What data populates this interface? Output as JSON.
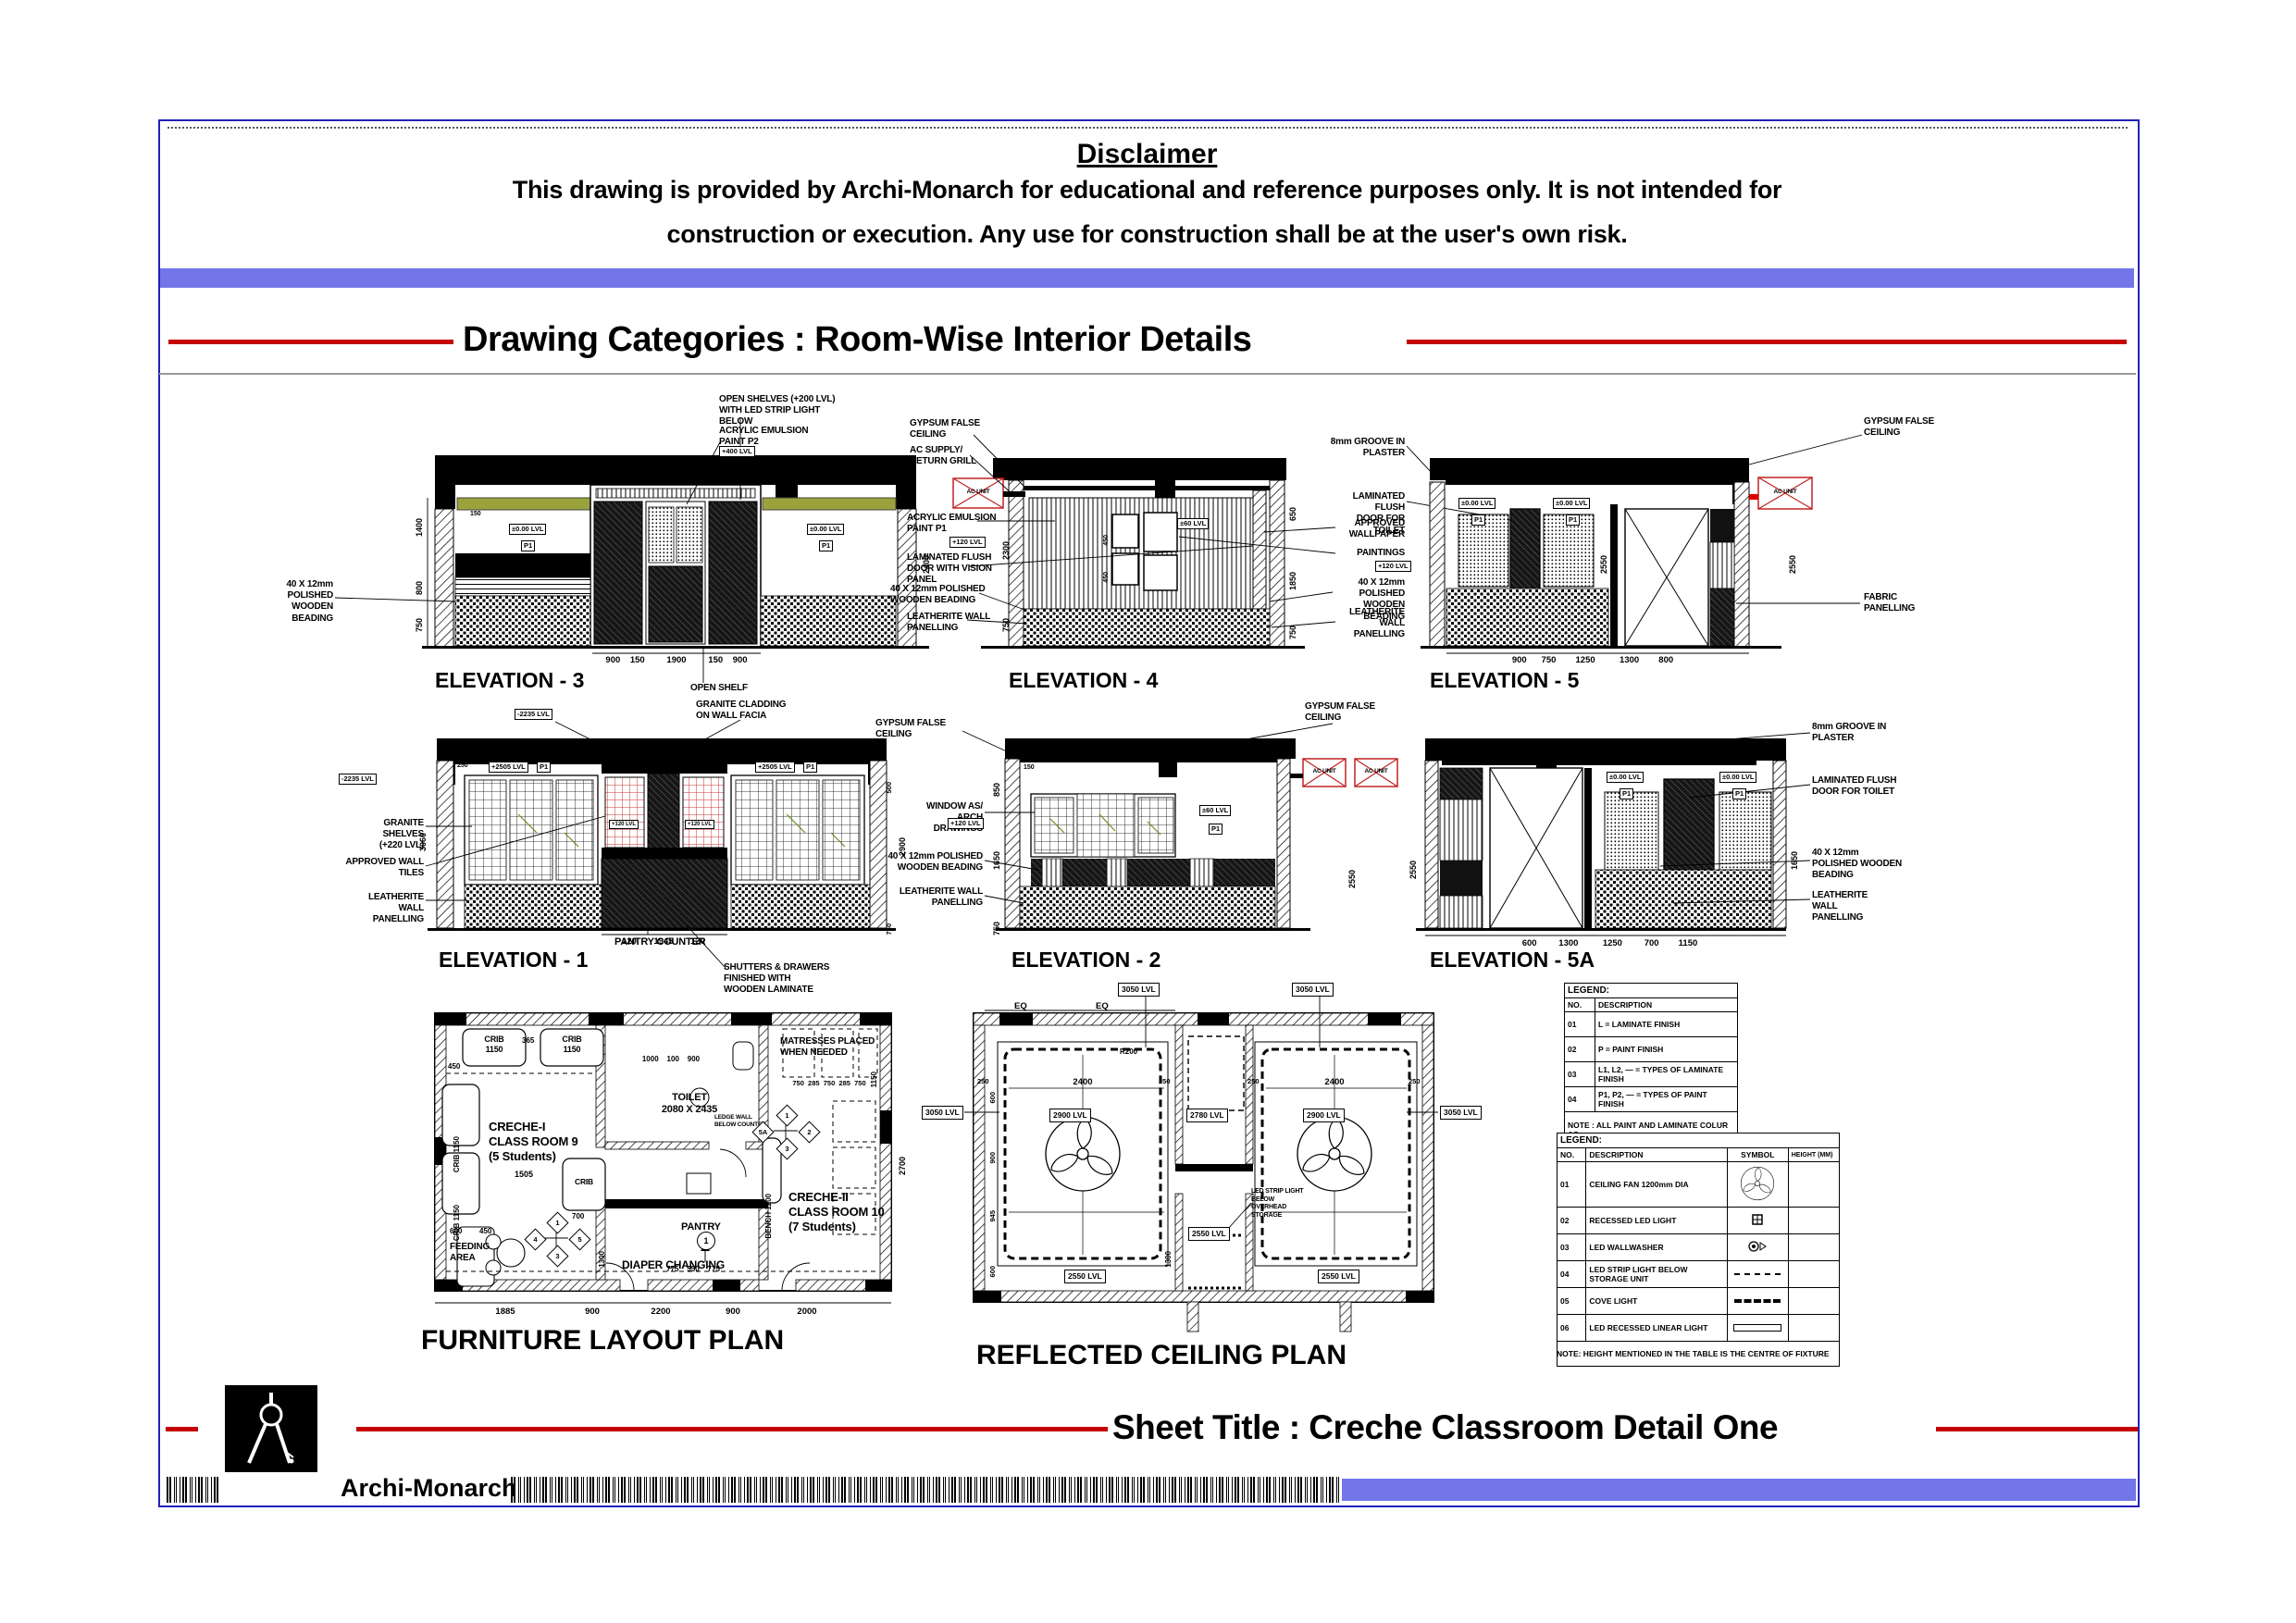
{
  "header": {
    "disclaimer_title": "Disclaimer",
    "disclaimer_line1": "This drawing is provided by Archi-Monarch for educational and reference purposes only. It is not intended for",
    "disclaimer_line2": "construction or execution. Any use for construction shall be at the user's own risk.",
    "category_title": "Drawing Categories : Room-Wise Interior Details"
  },
  "footer": {
    "sheet_title": "Sheet Title : Creche Classroom Detail One",
    "brand": "Archi-Monarch"
  },
  "e3": {
    "title": "ELEVATION - 3",
    "open_shelves": "OPEN SHELVES (+200 LVL)\nWITH LED STRIP LIGHT\nBELOW",
    "acrylic": "ACRYLIC EMULSION\nPAINT P2",
    "tag_400": "+400 LVL",
    "beading": "40 X 12mm\nPOLISHED\nWOODEN\nBEADING",
    "open_shelf": "OPEN SHELF",
    "lvl": "±0.00 LVL",
    "p1": "P1",
    "lvl_b": "±0.00 LVL",
    "p1_b": "P1",
    "dims_bottom": "900    150         1900         150    900",
    "dims_left": [
      "1400",
      "800",
      "750"
    ],
    "dim_right": "2400",
    "dim_150": "150"
  },
  "e4": {
    "title": "ELEVATION - 4",
    "gypsum": "GYPSUM FALSE\nCEILING",
    "ac_supply": "AC SUPPLY/\nRETURN GRILL",
    "acrylic": "ACRYLIC EMULSION\nPAINT P1",
    "tag_120": "+120 LVL",
    "flush_door": "LAMINATED FLUSH\nDOOR WITH VISION\nPANEL",
    "beading": "40 X 12mm POLISHED\nWOODEN BEADING",
    "leatherite": "LEATHERITE WALL\nPANELLING",
    "ac_unit": "AC UNIT",
    "tag_60": "±60 LVL",
    "dims_left": [
      "2300",
      "750"
    ],
    "dims_right": [
      "650",
      "1850",
      "750"
    ],
    "dim_450a": "450",
    "dim_450b": "450",
    "dim_150": "150"
  },
  "e45": {
    "groove": "8mm GROOVE IN\nPLASTER",
    "toilet_door": "LAMINATED FLUSH\nDOOR FOR TOILET",
    "wallpaper": "APPROVED\nWALLPAPER",
    "paintings": "PAINTINGS",
    "tag_120": "+120 LVL",
    "beading": "40 X 12mm\nPOLISHED WOODEN\nBEADING",
    "leatherite": "LEATHERITE\nWALL\nPANELLING"
  },
  "e5": {
    "title": "ELEVATION - 5",
    "gypsum": "GYPSUM FALSE\nCEILING",
    "fabric": "FABRIC\nPANELLING",
    "ac_unit": "AC UNIT",
    "lvl": "±0.00 LVL",
    "p1": "P1",
    "lvl_b": "±0.00 LVL",
    "p1_b": "P1",
    "dims_bottom": "900      750        1250          1300        800",
    "dims_right": [
      "2550",
      "2550"
    ]
  },
  "e1": {
    "title": "ELEVATION - 1",
    "granite_cladding": "GRANITE CLADDING\nON WALL FACIA",
    "granite_shelves": "GRANITE SHELVES\n(+220 LVL)",
    "wall_tiles": "APPROVED WALL\nTILES",
    "leatherite": "LEATHERITE WALL\nPANELLING",
    "pantry_counter": "PANTRY COUNTER",
    "shutters": "SHUTTERS & DRAWERS\nFINISHED WITH\nWOODEN LAMINATE",
    "tag_2235a": "-2235 LVL",
    "tag_2235b": "-2235 LVL",
    "tag_2505a": "+2505 LVL",
    "p1a": "P1",
    "tag_2505b": "+2505 LVL",
    "p1b": "P1",
    "tag_120a": "+120 LVL",
    "tag_120b": "+120 LVL",
    "dims_bottom": "120       1945       120",
    "dim_3060": "3060",
    "dim_2900": "2900",
    "dim_500": "500",
    "dim_750": "750",
    "dim_250": "250",
    "dim_150": "150"
  },
  "e2": {
    "title": "ELEVATION - 2",
    "gypsum_l": "GYPSUM FALSE\nCEILING",
    "gypsum_r": "GYPSUM FALSE\nCEILING",
    "window": "WINDOW AS/ ARCH\nDRAWINGS",
    "tag_120": "+120 LVL",
    "beading": "40 X 12mm POLISHED\nWOODEN BEADING",
    "leatherite": "LEATHERITE WALL\nPANELLING",
    "ac_unit_a": "AC UNIT",
    "ac_unit_b": "AC UNIT",
    "tag_60": "±60 LVL",
    "p1": "P1",
    "dims_left": [
      "850",
      "1650",
      "750"
    ],
    "dim_2550": "2550",
    "dim_150": "150"
  },
  "e5a": {
    "title": "ELEVATION - 5A",
    "groove": "8mm GROOVE IN\nPLASTER",
    "toilet_door": "LAMINATED FLUSH\nDOOR FOR TOILET",
    "beading": "40 X 12mm\nPOLISHED WOODEN\nBEADING",
    "leatherite": "LEATHERITE\nWALL\nPANELLING",
    "lvl_a": "±0.00 LVL",
    "p1_a": "P1",
    "lvl_b": "±0.00 LVL",
    "p1_b": "P1",
    "dims_bottom": "600         1300          1250         700        1150",
    "dim_2550": "2550",
    "dim_1650": "1650"
  },
  "flp": {
    "title": "FURNITURE LAYOUT PLAN",
    "room1": "CRECHE-I\nCLASS ROOM 9\n(5 Students)",
    "room2": "CRECHE-II\nCLASS ROOM 10\n(7 Students)",
    "toilet": "TOILET\n2080 X 2435",
    "pantry": "PANTRY",
    "feeding": "FEEDING\nAREA",
    "diaper": "DIAPER CHANGING",
    "mattress": "MATRESSES PLACED\nWHEN NEEDED",
    "ledge": "LEDGE WALL\nBELOW COUNTER",
    "bench": "BENCH 1200",
    "crib_a": "CRIB\n1150",
    "crib_b": "CRIB\n1150",
    "crib_c": "CRIB 1150",
    "crib_d": "CRIB 1150",
    "crib_e": "CRIB",
    "crib_e_dim": "700",
    "m1": "1",
    "m2": "2",
    "m3": "3",
    "m4": "4",
    "m5": "5",
    "m5a": "5A",
    "m1b": "1",
    "m3b": "3",
    "mc": "1",
    "dims_bottom": [
      "1885",
      "900",
      "2200",
      "900",
      "2000"
    ],
    "dims_top": "1000    100    900",
    "dims_mat": "750  285  750  285  750",
    "dims_diaper": "775    350    775",
    "dim_365": "365",
    "dim_450": "450",
    "dim_1505": "1505",
    "dim_1300": "1300",
    "dim_600": "600",
    "dim_450b": "450",
    "dim_2700": "2700",
    "dim_1150": "1150"
  },
  "rcp": {
    "title": "REFLECTED CEILING PLAN",
    "tag_3050": [
      "3050 LVL",
      "3050 LVL",
      "3050 LVL",
      "3050 LVL"
    ],
    "tag_2900a": "2900 LVL",
    "tag_2900b": "2900 LVL",
    "tag_2780": "2780 LVL",
    "tag_2550a": "2550 LVL",
    "tag_2550b": "2550 LVL",
    "tag_2550c": "2550 LVL",
    "led_note": "LED STRIP LIGHT\nBELOW\nOVERHEAD\nSTORAGE",
    "eq1": "EQ",
    "eq2": "EQ",
    "dim_2400a": "2400",
    "dim_2400b": "2400",
    "dim_250a": "250",
    "dim_250b": "250",
    "dim_250c": "250",
    "dim_250d": "250",
    "dims_left": [
      "600",
      "900",
      "945",
      "600"
    ],
    "dim_1300": "1300",
    "dim_r200": "R200"
  },
  "legend1": {
    "title": "LEGEND:",
    "h_no": "NO.",
    "h_desc": "DESCRIPTION",
    "rows": [
      [
        "01",
        "L = LAMINATE FINISH"
      ],
      [
        "02",
        "P = PAINT FINISH"
      ],
      [
        "03",
        "L1, L2, — = TYPES OF LAMINATE FINISH"
      ],
      [
        "04",
        "P1, P2, — = TYPES OF PAINT FINISH"
      ]
    ],
    "note": "NOTE : ALL PAINT AND LAMINATE COLUR AS\nPER SAMPLE APPROVED."
  },
  "legend2": {
    "title": "LEGEND:",
    "h_no": "NO.",
    "h_desc": "DESCRIPTION",
    "h_sym": "SYMBOL",
    "h_h": "HEIGHT (MM)",
    "rows": [
      [
        "01",
        "CEILING FAN 1200mm DIA"
      ],
      [
        "02",
        "RECESSED LED LIGHT"
      ],
      [
        "03",
        "LED WALLWASHER"
      ],
      [
        "04",
        "LED STRIP LIGHT  BELOW STORAGE UNIT"
      ],
      [
        "05",
        "COVE LIGHT"
      ],
      [
        "06",
        "LED RECESSED LINEAR LIGHT"
      ]
    ],
    "note": "NOTE: HEIGHT MENTIONED IN THE TABLE IS THE  CENTRE OF FIXTURE"
  }
}
